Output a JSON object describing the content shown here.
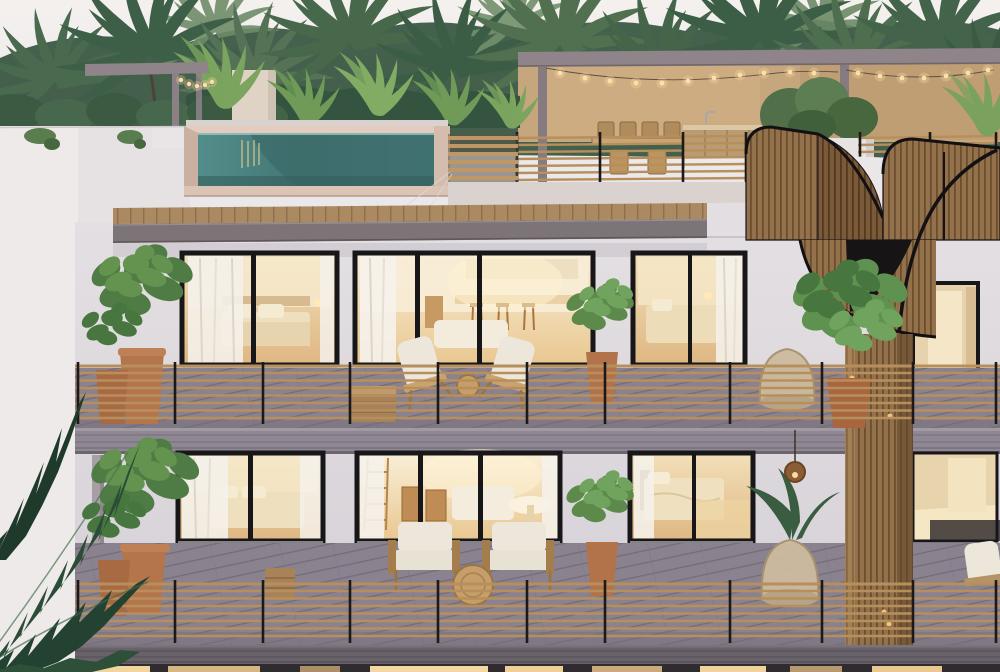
{
  "alt_text": "Dusk 3D exterior rendering of a modern tropical three-storey residence: rooftop terrace with glass-walled plunge pool, pergola with string lights, outdoor dining and bar, a curved wooden-slat spiral staircase on the right, and two balcony floors with floor-to-ceiling warm-lit windows, wood-rod railings, potted plants and lounge chairs, surrounded by palm trees",
  "scene": {
    "setting": "tropical residential building at dusk",
    "floors_visible": 3,
    "features": [
      "rooftop plunge pool",
      "pergola with string lights",
      "outdoor dining set",
      "outdoor bar counter",
      "spiral wooden staircase",
      "balcony lounge chairs",
      "potted plants",
      "palm canopy backdrop",
      "foreground palm fronds"
    ]
  },
  "palette": {
    "sky_top": "#f3efed",
    "sky_bottom": "#e9e6e9",
    "foliage_dark": "#31503c",
    "foliage_mid": "#44654a",
    "foliage_light": "#6f8c68",
    "banana_green": "#7ba45e",
    "wall": "#dfdbdf",
    "wall_side": "#eeeae9",
    "rooftop_wall": "#c6a67c",
    "beam": "#8e8489",
    "concrete": "#7d7478",
    "terrazzo": "#d9d2cf",
    "pool_water": "#4f8987",
    "pool_water_dark": "#3c6b69",
    "pool_coping": "#dcc4b5",
    "canopy_wood": "#ab8a61",
    "deck": "#8b8290",
    "slab": "#8f8792",
    "fascia": "#69626a",
    "rail_wood": "#b78f5c",
    "rail_post": "#1c191a",
    "frame": "#17171a",
    "interior_warm": "#f8ecd2",
    "interior_deep": "#e4bd85",
    "curtain": "#f5f1ea",
    "cushion": "#ece7da",
    "terracotta": "#b4754b",
    "stair_wood": "#93714a",
    "stair_wood_dark": "#7a5a39",
    "stair_edge": "#121012",
    "plant_green": "#5d8a4a",
    "plant_green_dark": "#3a5c40",
    "string_light": "#ffdfa8",
    "window_glow": "#f3d8a4",
    "foreground_palm": "#2b4c37"
  }
}
